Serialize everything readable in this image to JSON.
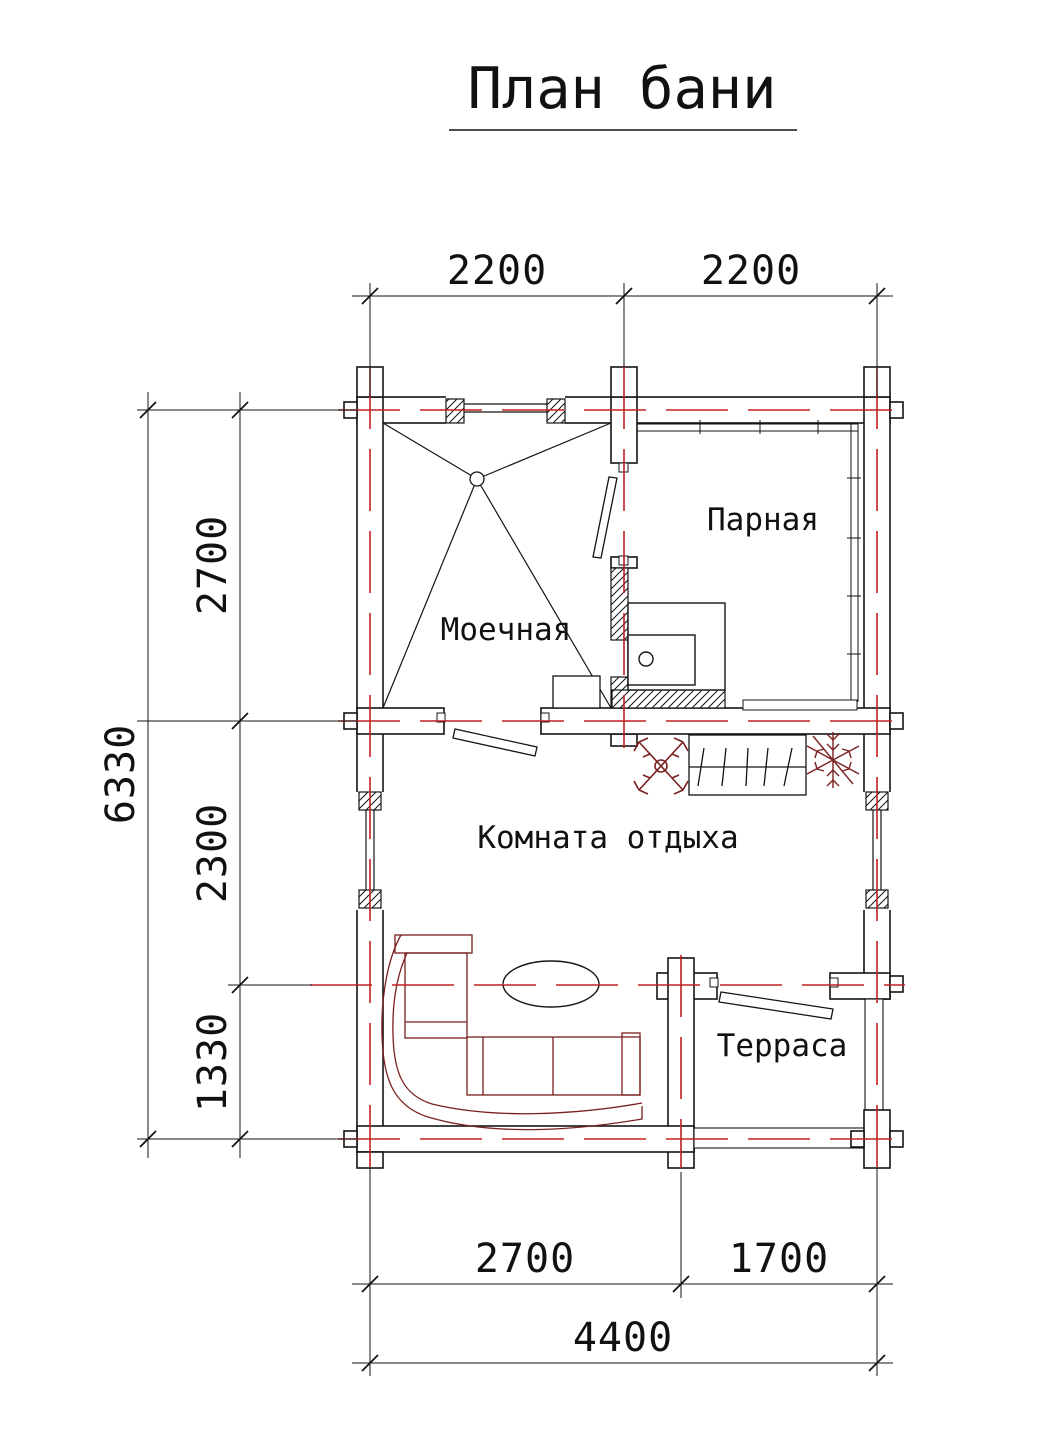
{
  "title": "План бани",
  "rooms": {
    "parnaya": "Парная",
    "moechnaya": "Моечная",
    "komnata_otdyha": "Комната отдыха",
    "terrasa": "Терраса"
  },
  "dimensions": {
    "top": [
      "2200",
      "2200"
    ],
    "left": [
      "2700",
      "2300",
      "1330"
    ],
    "left_total": "6330",
    "bottom": [
      "2700",
      "1700"
    ],
    "bottom_total": "4400"
  },
  "colors": {
    "axis": "#c02020",
    "furniture": "#7a2020",
    "ink": "#141414"
  },
  "symbols": {
    "drain": "floor-drain",
    "stove": "sauna-stove",
    "hanger": "wall-coat-hanger",
    "plant_left": "decorative-plant",
    "plant_right": "decorative-plant",
    "sofa": "corner-sofa",
    "table": "oval-table"
  }
}
